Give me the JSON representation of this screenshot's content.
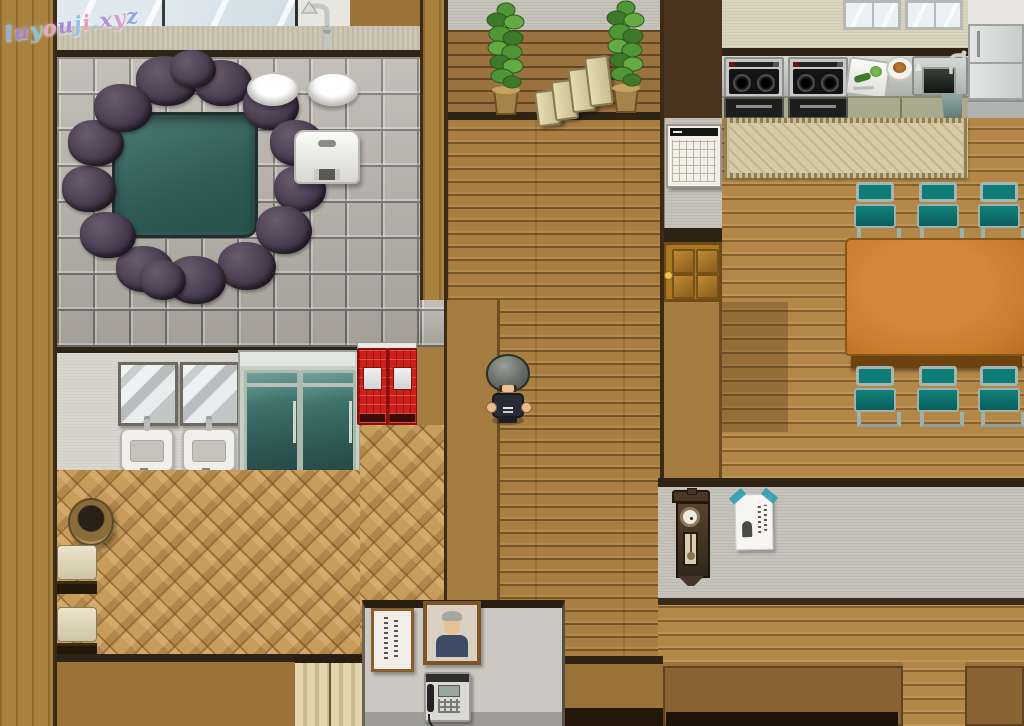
{
  "watermark": {
    "text": "luyouji.xyz",
    "colors": [
      "#86b4e8",
      "#9d82d6",
      "#7fc2e2",
      "#e3a8cc",
      "#a989dd",
      "#8fc3ea",
      "#e79cc0",
      "#95cbe3",
      "#b393da",
      "#de9fc6",
      "#8fa8e0"
    ]
  },
  "objects": {
    "hot_spring": "Rock-lined hot spring bath",
    "bath_window": "Bathhouse window",
    "shower": "Shower fixture",
    "wash_basin": "Wash basin",
    "bath_stool": "Bath stool",
    "mirror": "Wall mirror",
    "sink": "Washroom sink",
    "locker_cabinet": "Glass locker cabinet",
    "vending_machine": "Red vending machine",
    "laundry_basket": "Wicker basket",
    "bench": "Changing bench",
    "noren_curtain": "Doorway curtain",
    "stairs": "Staircase",
    "potted_plant": "Potted plant",
    "player_character": "Player character",
    "wall_calendar": "Wall calendar",
    "wooden_door": "Wooden door",
    "stove": "Kitchen stove",
    "cutting_board": "Cutting board with vegetables",
    "dish": "Plate of food",
    "kitchen_sink": "Kitchen sink",
    "kitchen_window": "Kitchen window",
    "refrigerator": "Refrigerator",
    "trash_bin": "Trash bin",
    "tatami_rug": "Tatami rug",
    "dining_table": "Dining table",
    "dining_chair": "Dining chair",
    "wall_clock": "Antique wall clock",
    "poster": "Taped notice",
    "framed_sign": "Framed calligraphy sign",
    "portrait": "Framed portrait",
    "wall_phone": "Wall intercom phone"
  },
  "palette": {
    "wood_wall": "#a8813f",
    "plank_floor": "#a97f41",
    "tile_floor": "#b6b2a9",
    "spring_water": "#3f6f6d",
    "chair_teal": "#0e7a76",
    "table_orange": "#c87c2e",
    "vending_red": "#ce201a",
    "wall_gray": "#c6c3bb",
    "parquet": "#c89d5c"
  }
}
